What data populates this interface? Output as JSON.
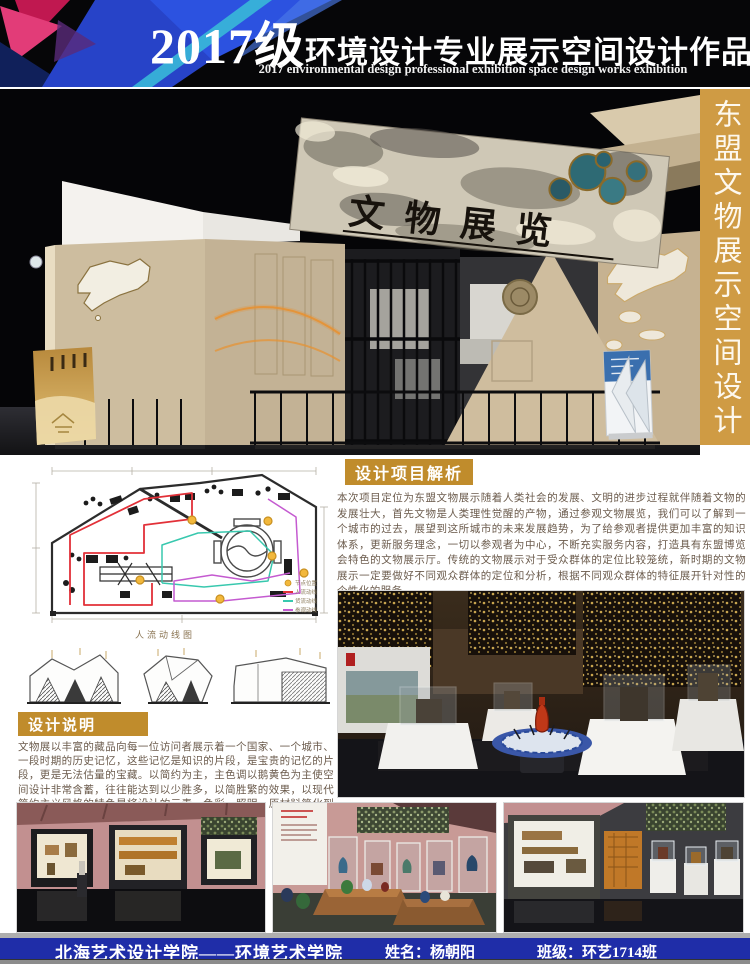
{
  "header": {
    "title_prefix": "2017级",
    "title_main": "环境设计专业展示空间设计作品展",
    "subtitle": "2017 environmental design professional exhibition space design works exhibition"
  },
  "side_banner": {
    "title": "东盟文物展示空间设计"
  },
  "hero": {
    "sign": "文物展览"
  },
  "analysis": {
    "heading": "设计项目解析",
    "body": "本次项目定位为东盟文物展示随着人类社会的发展、文明的进步过程就伴随着文物的发展壮大，首先文物是人类理性觉醒的产物，通过参观文物展览，我们可以了解到一个城市的过去，展望到这所城市的未来发展趋势，为了给参观者提供更加丰富的知识体系，更新服务理念，一切以参观者为中心，不断充实服务内容，打造具有东盟博览会特色的文物展示厅。传统的文物展示对于受众群体的定位比较笼统，新时期的文物展示一定要做好不同观众群体的定位和分析，根据不同观众群体的特征展开针对性的个性化的服务。"
  },
  "floorplan": {
    "caption": "人流动线图",
    "legend": [
      {
        "label": "节点位置",
        "color": "#f2b83c",
        "type": "dot"
      },
      {
        "label": "人流动线",
        "color": "#e23038",
        "type": "line"
      },
      {
        "label": "货流动线",
        "color": "#38c8ae",
        "type": "line"
      },
      {
        "label": "参观动线",
        "color": "#c45ad0",
        "type": "line"
      }
    ]
  },
  "description": {
    "heading": "设计说明",
    "body": "文物展以丰富的藏品向每一位访问者展示着一个国家、一个城市、一段时期的历史记忆，这些记忆是知识的片段，是宝贵的记忆的片段，更是无法估量的宝藏。以简约为主，主色调以鹅黄色为主使空间设计非常含蓄，往往能达到以少胜多，以简胜繁的效果，以现代简约主义风格的特色是将设计的元素、色彩、照明、原材料简化到最少的程度，但对色彩、材料的质感要求很高。"
  },
  "footer": {
    "school": "北海艺术设计学院——环境艺术学院",
    "name": "姓名：杨朝阳",
    "class_name": "班级：环艺1714班"
  },
  "colors": {
    "gold_bar": "#cf9b44",
    "heading_gold": "#c08c2c",
    "footer_blue": "#1f2da8",
    "node_yellow": "#f2b83c",
    "route_red": "#e23038",
    "route_cyan": "#38c8ae",
    "route_magenta": "#c45ad0"
  }
}
